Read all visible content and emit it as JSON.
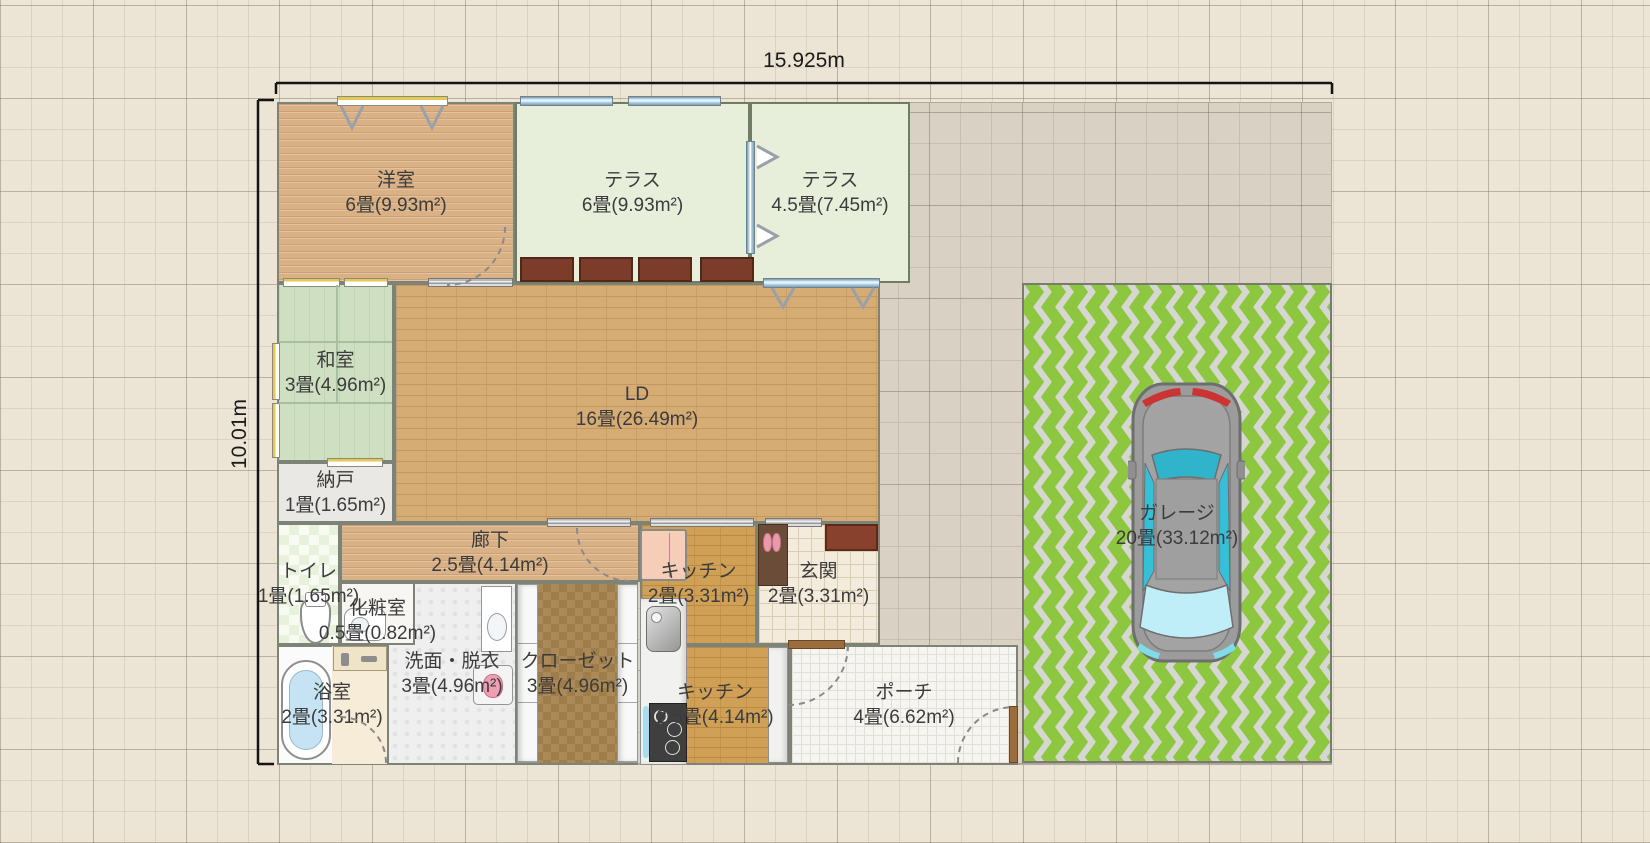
{
  "app": {
    "view": "floorplan-editor-canvas"
  },
  "dimensions": {
    "horizontal": "15.925m",
    "vertical": "10.01m"
  },
  "site": {
    "x": 277,
    "y": 102,
    "w": 1055,
    "h": 663
  },
  "rooms": [
    {
      "id": "youshitsu",
      "name": "洋室",
      "area": "6畳(9.93m²)",
      "x": 277,
      "y": 102,
      "w": 238,
      "h": 181,
      "floor": "wood"
    },
    {
      "id": "terrace6",
      "name": "テラス",
      "area": "6畳(9.93m²)",
      "x": 515,
      "y": 102,
      "w": 235,
      "h": 181,
      "floor": "terrace"
    },
    {
      "id": "terrace45",
      "name": "テラス",
      "area": "4.5畳(7.45m²)",
      "x": 750,
      "y": 102,
      "w": 160,
      "h": 181,
      "floor": "terrace"
    },
    {
      "id": "washitsu",
      "name": "和室",
      "area": "3畳(4.96m²)",
      "x": 277,
      "y": 283,
      "w": 117,
      "h": 179,
      "floor": "tatami"
    },
    {
      "id": "ld",
      "name": "LD",
      "area": "16畳(26.49m²)",
      "x": 394,
      "y": 283,
      "w": 486,
      "h": 240,
      "floor": "brick",
      "label_dy": 4
    },
    {
      "id": "nando",
      "name": "納戸",
      "area": "1畳(1.65m²)",
      "x": 277,
      "y": 462,
      "w": 117,
      "h": 61,
      "floor": "plain"
    },
    {
      "id": "rouka",
      "name": "廊下",
      "area": "2.5畳(4.14m²)",
      "x": 340,
      "y": 523,
      "w": 300,
      "h": 59,
      "floor": "wood"
    },
    {
      "id": "toilet",
      "name": "トイレ",
      "area": "1畳(1.65m²)",
      "x": 277,
      "y": 523,
      "w": 63,
      "h": 122,
      "floor": "checker-green"
    },
    {
      "id": "senmen",
      "name": "洗面・脱衣",
      "area": "3畳(4.96m²)",
      "x": 387,
      "y": 582,
      "w": 130,
      "h": 183,
      "floor": "tile-dot"
    },
    {
      "id": "keshou",
      "name": "化粧室",
      "area": "0.5畳(0.82m²)",
      "x": 340,
      "y": 582,
      "w": 75,
      "h": 63,
      "floor": "plain-white",
      "label_dy": 7
    },
    {
      "id": "closet",
      "name": "クローゼット",
      "area": "3畳(4.96m²)",
      "x": 517,
      "y": 582,
      "w": 121,
      "h": 183,
      "floor": "checker-brown"
    },
    {
      "id": "bath",
      "name": "浴室",
      "area": "2畳(3.31m²)",
      "x": 277,
      "y": 645,
      "w": 110,
      "h": 120,
      "floor": "bath"
    },
    {
      "id": "kitchen2",
      "name": "キッチン",
      "area": "2畳(3.31m²)",
      "x": 640,
      "y": 523,
      "w": 117,
      "h": 122,
      "floor": "brick-k"
    },
    {
      "id": "genkan",
      "name": "玄関",
      "area": "2畳(3.31m²)",
      "x": 757,
      "y": 523,
      "w": 123,
      "h": 122,
      "floor": "tile-cream"
    },
    {
      "id": "kitchen25",
      "name": "キッチン",
      "area": "2.5畳(4.14m²)",
      "x": 640,
      "y": 645,
      "w": 150,
      "h": 120,
      "floor": "brick-k"
    },
    {
      "id": "porch",
      "name": "ポーチ",
      "area": "4畳(6.62m²)",
      "x": 790,
      "y": 645,
      "w": 228,
      "h": 120,
      "floor": "tile-white"
    },
    {
      "id": "garage",
      "name": "ガレージ",
      "area": "20畳(33.12m²)",
      "x": 1022,
      "y": 283,
      "w": 310,
      "h": 480,
      "floor": "chevron",
      "label_dy": 3
    }
  ],
  "fixtures": [
    {
      "type": "window-wood",
      "x": 337,
      "y": 96,
      "w": 111,
      "h": 10
    },
    {
      "type": "window-wood",
      "x": 283,
      "y": 278,
      "w": 57,
      "h": 9
    },
    {
      "type": "window-wood",
      "x": 344,
      "y": 278,
      "w": 44,
      "h": 9
    },
    {
      "type": "window-wood-v",
      "x": 272,
      "y": 343,
      "w": 8,
      "h": 57
    },
    {
      "type": "window-wood-v",
      "x": 272,
      "y": 403,
      "w": 8,
      "h": 55
    },
    {
      "type": "window-wood",
      "x": 327,
      "y": 458,
      "w": 56,
      "h": 9
    },
    {
      "type": "window-blue",
      "x": 520,
      "y": 96,
      "w": 93,
      "h": 10
    },
    {
      "type": "window-blue",
      "x": 628,
      "y": 96,
      "w": 93,
      "h": 10
    },
    {
      "type": "window-blue-v",
      "x": 746,
      "y": 141,
      "w": 9,
      "h": 113
    },
    {
      "type": "window-blue",
      "x": 763,
      "y": 278,
      "w": 117,
      "h": 10
    },
    {
      "type": "slide-door",
      "x": 428,
      "y": 278,
      "w": 85,
      "h": 9
    },
    {
      "type": "slide-door",
      "x": 547,
      "y": 518,
      "w": 84,
      "h": 9
    },
    {
      "type": "slide-door",
      "x": 650,
      "y": 518,
      "w": 104,
      "h": 9
    },
    {
      "type": "slide-door",
      "x": 765,
      "y": 518,
      "w": 57,
      "h": 9
    },
    {
      "type": "door-bar-h",
      "x": 788,
      "y": 640,
      "w": 57,
      "h": 9
    },
    {
      "type": "door-bar-v",
      "x": 1009,
      "y": 706,
      "w": 9,
      "h": 57
    },
    {
      "type": "planter",
      "x": 520,
      "y": 257,
      "w": 54,
      "h": 25
    },
    {
      "type": "planter",
      "x": 579,
      "y": 257,
      "w": 54,
      "h": 25
    },
    {
      "type": "planter",
      "x": 638,
      "y": 257,
      "w": 54,
      "h": 25
    },
    {
      "type": "planter",
      "x": 700,
      "y": 257,
      "w": 54,
      "h": 25
    },
    {
      "type": "step",
      "x": 825,
      "y": 524,
      "w": 53,
      "h": 27
    },
    {
      "type": "shoe-cabinet",
      "x": 758,
      "y": 524,
      "w": 30,
      "h": 62
    },
    {
      "type": "slippers",
      "x": 763,
      "y": 532,
      "w": 18,
      "h": 20
    },
    {
      "type": "fridge",
      "x": 640,
      "y": 529,
      "w": 47,
      "h": 52
    },
    {
      "type": "counter",
      "x": 640,
      "y": 598,
      "w": 47,
      "h": 167
    },
    {
      "type": "sink",
      "x": 646,
      "y": 606,
      "w": 35,
      "h": 46
    },
    {
      "type": "sink-strip",
      "x": 643,
      "y": 706,
      "w": 6,
      "h": 52
    },
    {
      "type": "stove",
      "x": 649,
      "y": 703,
      "w": 38,
      "h": 59
    },
    {
      "type": "counter",
      "x": 768,
      "y": 647,
      "w": 20,
      "h": 116
    },
    {
      "type": "vanity",
      "x": 481,
      "y": 586,
      "w": 31,
      "h": 66
    },
    {
      "type": "washer",
      "x": 473,
      "y": 665,
      "w": 40,
      "h": 40
    },
    {
      "type": "shelf",
      "x": 517,
      "y": 584,
      "w": 21,
      "h": 179
    },
    {
      "type": "shelf",
      "x": 617,
      "y": 584,
      "w": 21,
      "h": 179
    },
    {
      "type": "toilet",
      "x": 300,
      "y": 597,
      "w": 31,
      "h": 47
    },
    {
      "type": "basin",
      "x": 344,
      "y": 608,
      "w": 42,
      "h": 33
    },
    {
      "type": "bath-floor",
      "x": 332,
      "y": 646,
      "w": 55,
      "h": 118
    },
    {
      "type": "shower",
      "x": 333,
      "y": 646,
      "w": 54,
      "h": 25
    },
    {
      "type": "bathtub",
      "x": 281,
      "y": 660,
      "w": 50,
      "h": 100
    },
    {
      "type": "tatami-line-v",
      "x": 336,
      "y": 285,
      "w": 2,
      "h": 118
    },
    {
      "type": "tatami-line-h",
      "x": 279,
      "y": 341,
      "w": 113,
      "h": 2
    },
    {
      "type": "tatami-line-h",
      "x": 279,
      "y": 402,
      "w": 113,
      "h": 2
    },
    {
      "type": "car",
      "x": 1128,
      "y": 375,
      "w": 117,
      "h": 293
    }
  ],
  "door_arcs": [
    {
      "name": "door-swing-youshitsu",
      "d": "M 505,227 A 58 58 0 0 1 447,285"
    },
    {
      "name": "door-swing-rouka",
      "d": "M 577,528 A 53 53 0 0 0 630,581"
    },
    {
      "name": "door-swing-bath",
      "d": "M 340,717 A 46 46 0 0 1 386,763"
    },
    {
      "name": "door-swing-porch-in",
      "d": "M 788,705 A 60 60 0 0 0 848,645"
    },
    {
      "name": "door-swing-porch-out",
      "d": "M 958,763 A 56 56 0 0 1 1014,707"
    }
  ],
  "marks": [
    {
      "name": "curtain-hook",
      "d": "M 341,106 L 352,128 L 363,106",
      "fill": "none"
    },
    {
      "name": "curtain-hook",
      "d": "M 421,106 L 432,128 L 443,106",
      "fill": "none"
    },
    {
      "name": "curtain-hook",
      "d": "M 772,288 L 783,307 L 794,288",
      "fill": "none"
    },
    {
      "name": "curtain-hook",
      "d": "M 852,288 L 863,307 L 874,288",
      "fill": "none"
    },
    {
      "name": "casement-wing",
      "d": "M 757,146 L 777,157 L 757,168",
      "fill": "#ffffff"
    },
    {
      "name": "casement-wing",
      "d": "M 757,225 L 777,236 L 757,247",
      "fill": "#ffffff"
    }
  ],
  "dimension_lines": [
    "M 276,83 L 1332,83",
    "M 276,83 L 276,94",
    "M 1332,83 L 1332,94",
    "M 258,100 L 258,764",
    "M 258,100 L 274,100",
    "M 258,764 L 274,764"
  ],
  "dimension_label_pos": {
    "horizontal": {
      "x": 804,
      "y": 61
    },
    "vertical": {
      "x": 240,
      "y": 434
    }
  },
  "colors": {
    "canvas_bg": "#ece4d4",
    "site_bg": "#d9d1c3",
    "wall": "#7d8376",
    "terrace_wall": "#6f7d63",
    "dimension": "#141414",
    "label_text": "#3c3c3c",
    "garage_stripe": "#8dc63f",
    "garage_bg": "#d7d7d2",
    "wood_floor": "#dab185",
    "ld_brick": "#d6ac75",
    "kitchen_brick": "#d1a057",
    "tatami": "#cfdfc2",
    "terrace_floor": "#e7efdb",
    "closet_floor": "#ac8a58",
    "planter": "#7b3d29",
    "window_blue": "#a9d3ee",
    "window_yellow": "#e6c94f",
    "car_body": "#9c9c9c",
    "car_glass": "#35c0d8",
    "car_taillight": "#cc3333"
  }
}
